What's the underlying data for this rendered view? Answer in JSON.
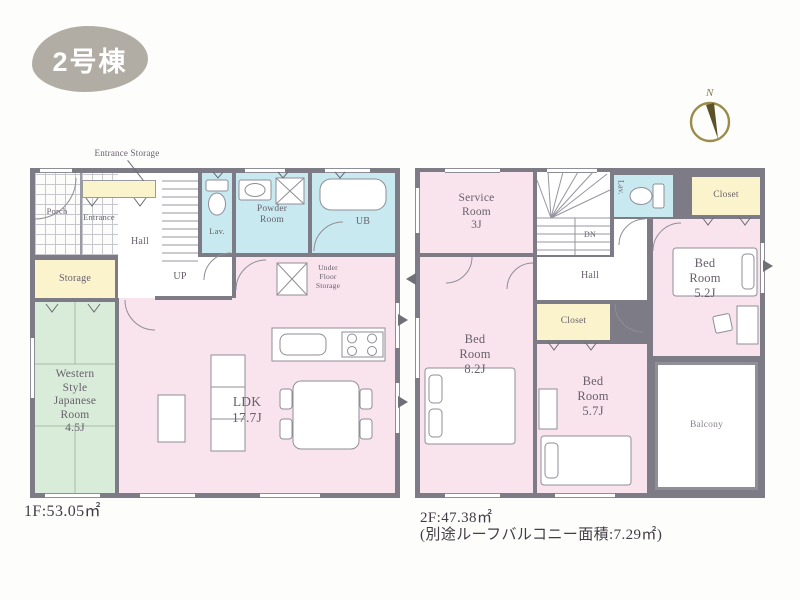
{
  "header": {
    "badge": "2号棟"
  },
  "compass": {
    "north": "N"
  },
  "floor1": {
    "area": "1F:53.05㎡",
    "labels": {
      "entrance_storage": "Entrance Storage",
      "porch": "Porch",
      "entrance": "Entrance",
      "hall": "Hall",
      "up": "UP",
      "lav": "Lav.",
      "powder_room": "Powder Room",
      "ub": "UB",
      "storage": "Storage",
      "japanese_name": "Western Style Japanese Room",
      "japanese_size": "4.5J",
      "ldk_name": "LDK",
      "ldk_size": "17.7J",
      "under_floor": "Under Floor Storage"
    }
  },
  "floor2": {
    "area": "2F:47.38㎡",
    "area_note": "(別途ルーフバルコニー面積:7.29㎡)",
    "labels": {
      "service_name": "Service Room",
      "service_size": "3J",
      "dn": "DN",
      "lav": "Lav.",
      "closet_top": "Closet",
      "closet_mid": "Closet",
      "hall": "Hall",
      "bed_main_name": "Bed Room",
      "bed_main_size": "8.2J",
      "bed_mid_name": "Bed Room",
      "bed_mid_size": "5.7J",
      "bed_right_name": "Bed Room",
      "bed_right_size": "5.2J",
      "balcony": "Balcony"
    }
  },
  "colors": {
    "wall": "#7d7c86",
    "room_pink": "#f9e4ee",
    "room_blue": "#c9e9f1",
    "room_green": "#d9ecd9",
    "closet_yellow": "#faf3cc",
    "badge_gray": "#b2ada4",
    "compass_olive": "#8b7d3f"
  }
}
